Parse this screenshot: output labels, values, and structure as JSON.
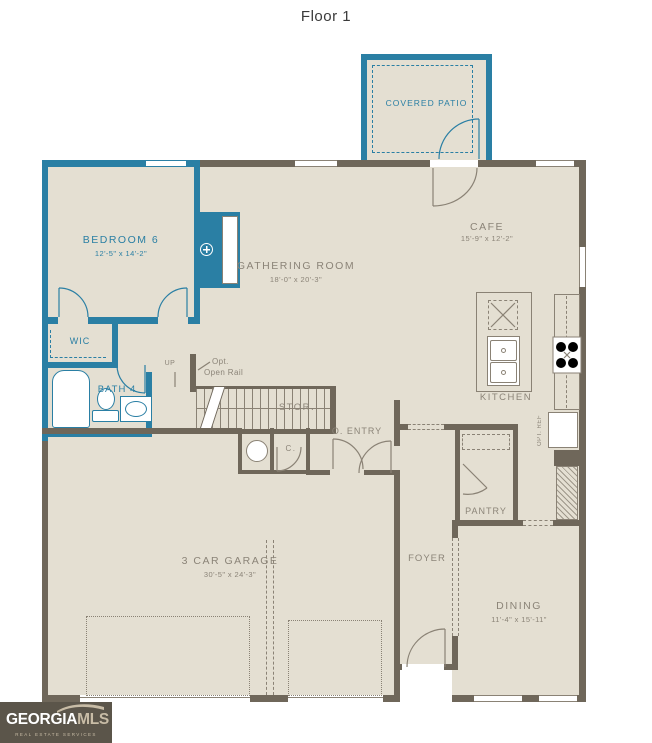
{
  "title": "Floor 1",
  "colors": {
    "teal": "#2a7fa4",
    "wall": "#6f675a",
    "floor": "#e4dfd2",
    "gray": "#8b8478",
    "line": "#8a8275",
    "logo_bg": "#5b554a",
    "logo_tan": "#c8bca6"
  },
  "rooms": {
    "covered_patio": {
      "label": "COVERED PATIO"
    },
    "bedroom6": {
      "label": "BEDROOM 6",
      "dims": "12'-5\" x 14'-2\""
    },
    "gathering": {
      "label": "GATHERING ROOM",
      "dims": "18'-0\" x 20'-3\""
    },
    "cafe": {
      "label": "CAFE",
      "dims": "15'-9\" x 12'-2\""
    },
    "kitchen": {
      "label": "KITCHEN"
    },
    "wic": {
      "label": "WIC"
    },
    "bath4": {
      "label": "BATH 4"
    },
    "garage": {
      "label": "3 CAR GARAGE",
      "dims": "30'-5\" x 24'-3\""
    },
    "o_entry": {
      "label": "O. ENTRY"
    },
    "stor": {
      "label": "STOR."
    },
    "closet": {
      "label": "C."
    },
    "pantry": {
      "label": "PANTRY"
    },
    "foyer": {
      "label": "FOYER"
    },
    "dining": {
      "label": "DINING",
      "dims": "11'-4\" x 15'-11\""
    }
  },
  "annotations": {
    "up": "UP",
    "opt_rail_line1": "Opt.",
    "opt_rail_line2": "Open Rail",
    "opt_ref": "OPT. REF"
  },
  "logo": {
    "brand": "GEORGIA",
    "suffix": "MLS",
    "tagline": "REAL ESTATE SERVICES"
  }
}
